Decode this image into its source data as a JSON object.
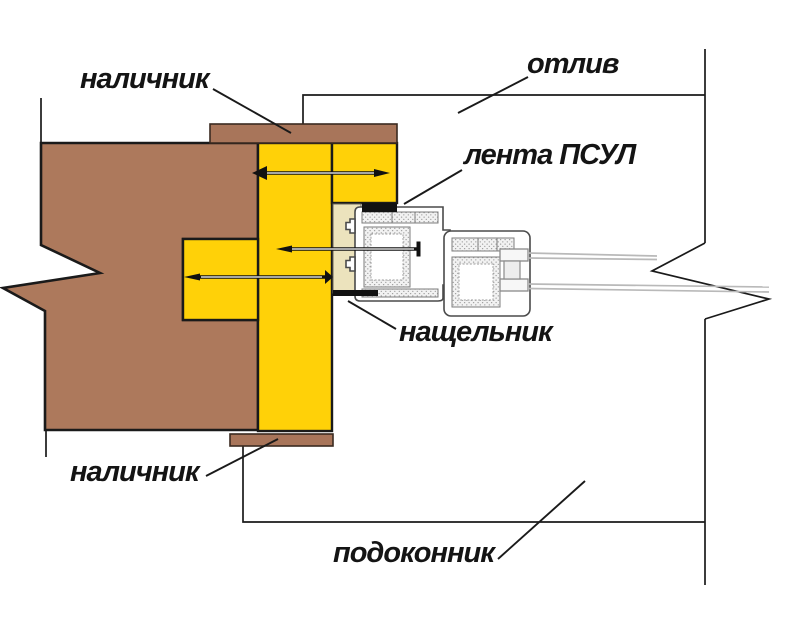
{
  "diagram": {
    "labels": {
      "architrave_top": "наличник",
      "drip_cap": "отлив",
      "psul_tape": "лента ПСУЛ",
      "flashing_strip": "нащельник",
      "architrave_bottom": "наличник",
      "windowsill": "подоконник"
    },
    "colors": {
      "background": "#ffffff",
      "wall": "#ad795c",
      "architrave": "#a8755a",
      "window_box": "#ffd108",
      "foam_strip": "#ece3bd",
      "tape": "#111111",
      "outline": "#1a1a1a",
      "profile": "#4a4a4a",
      "glass": "#b9b9b9"
    }
  }
}
